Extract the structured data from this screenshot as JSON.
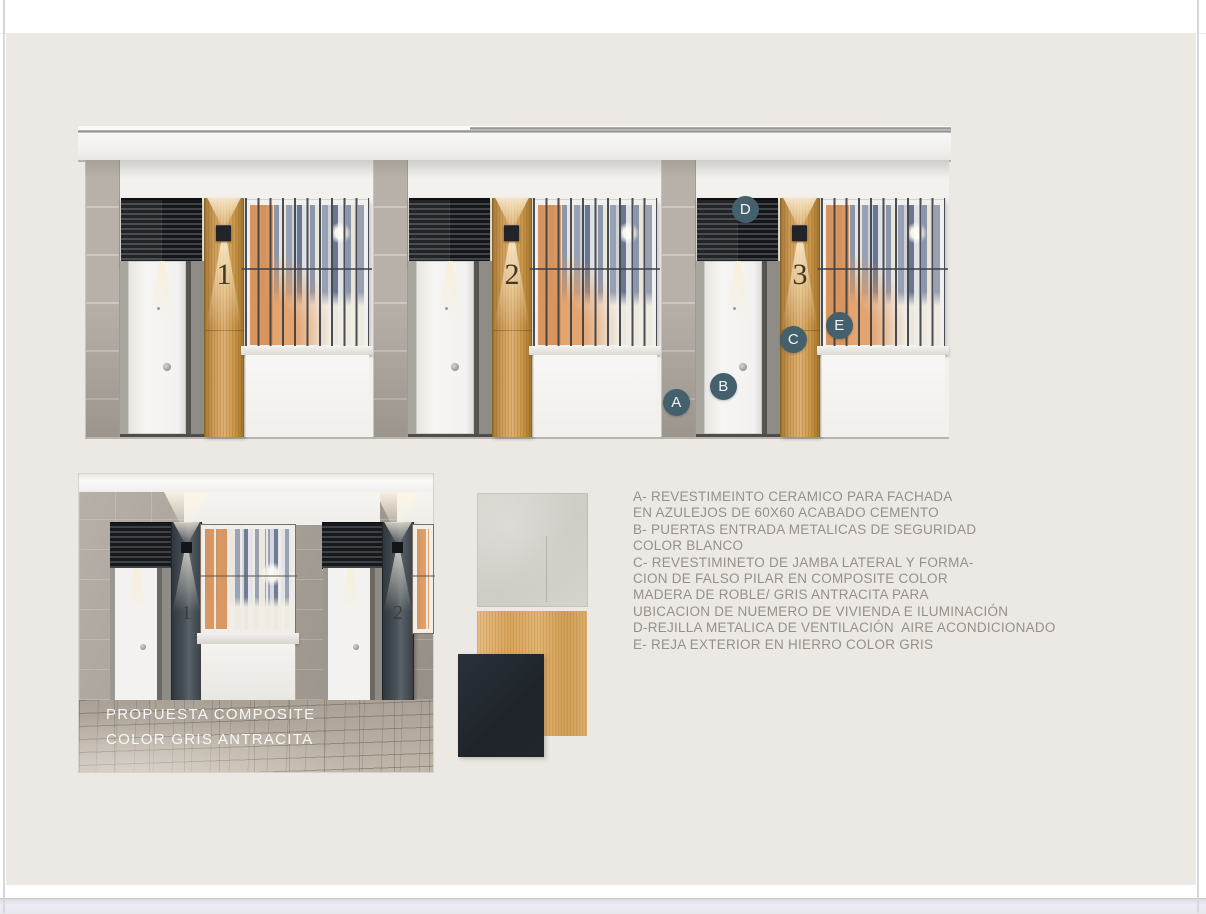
{
  "window": {
    "background_color": "#ffffff",
    "canvas_color": "#ece8e3"
  },
  "elevation": {
    "title": "facade-elevation-three-units",
    "units": [
      {
        "number": "1"
      },
      {
        "number": "2"
      },
      {
        "number": "3"
      }
    ],
    "markers": [
      {
        "label": "A"
      },
      {
        "label": "B"
      },
      {
        "label": "C"
      },
      {
        "label": "D"
      },
      {
        "label": "E"
      }
    ],
    "marker_color": "#44606c"
  },
  "proposal": {
    "caption_line1": "PROPUESTA COMPOSITE",
    "caption_line2": "COLOR GRIS ANTRACITA",
    "units": [
      {
        "number": "1"
      },
      {
        "number": "2"
      }
    ]
  },
  "swatches": [
    {
      "name": "ceramic-tile-60x60-cement",
      "color": "#d5d1cb"
    },
    {
      "name": "oak-wood-composite",
      "color": "#dfae6b"
    },
    {
      "name": "anthracite-grey-composite",
      "color": "#20262b"
    }
  ],
  "legend": {
    "text_color": "#97908a",
    "lines": [
      "A- REVESTIMEINTO CERAMICO PARA FACHADA",
      "EN AZULEJOS DE 60X60 ACABADO CEMENTO",
      "B- PUERTAS ENTRADA METALICAS DE SEGURIDAD",
      "COLOR BLANCO",
      "C- REVESTIMINETO DE JAMBA LATERAL Y FORMA-",
      "CION DE FALSO PILAR EN COMPOSITE COLOR",
      "MADERA DE ROBLE/ GRIS ANTRACITA PARA",
      "UBICACION DE NUEMERO DE VIVIENDA E ILUMINACIÓN",
      "D-REJILLA METALICA DE VENTILACIÓN  AIRE ACONDICIONADO",
      "E- REJA EXTERIOR EN HIERRO COLOR GRIS"
    ]
  }
}
